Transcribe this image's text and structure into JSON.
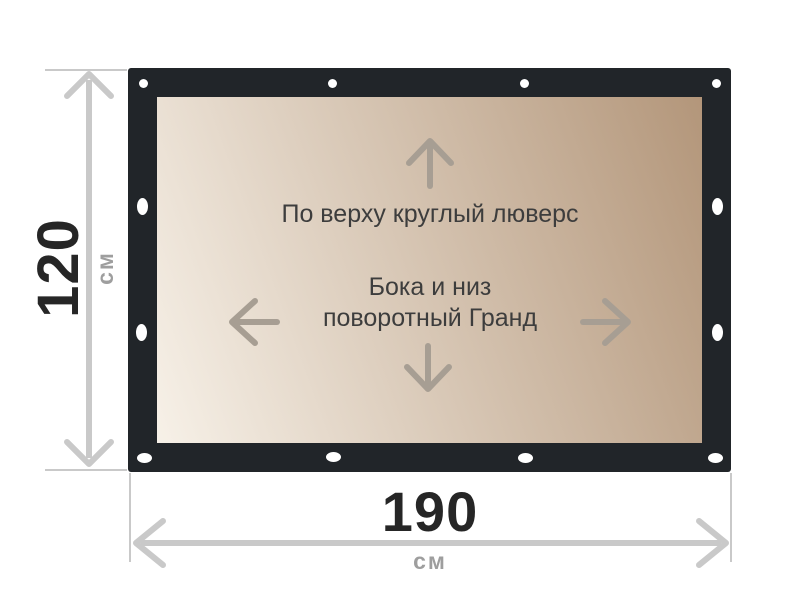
{
  "colors": {
    "background": "#ffffff",
    "frame": "#212529",
    "surface_light": "#f7f1e8",
    "surface_dark": "#b3967a",
    "grommet": "#ffffff",
    "dimension_line": "#c9c9c9",
    "dimension_number": "#262626",
    "dimension_unit": "#9e9e9e",
    "banner_text": "#3d3d3d",
    "banner_arrow": "#a79e93"
  },
  "banner": {
    "top_note": "По верху круглый люверс",
    "middle_note_line1": "Бока и низ",
    "middle_note_line2": "поворотный Гранд",
    "arrows": [
      {
        "name": "arrow-up-icon",
        "direction": "up"
      },
      {
        "name": "arrow-left-icon",
        "direction": "left"
      },
      {
        "name": "arrow-right-icon",
        "direction": "right"
      },
      {
        "name": "arrow-down-icon",
        "direction": "down"
      }
    ],
    "grommets": {
      "top": {
        "type": "round",
        "count": 4
      },
      "left": {
        "type": "oval-vertical",
        "count": 2
      },
      "right": {
        "type": "oval-vertical",
        "count": 2
      },
      "bottom": {
        "type": "oval-horizontal",
        "count": 4
      }
    }
  },
  "dimensions": {
    "height": {
      "value": "120",
      "unit": "см"
    },
    "width": {
      "value": "190",
      "unit": "см"
    }
  }
}
